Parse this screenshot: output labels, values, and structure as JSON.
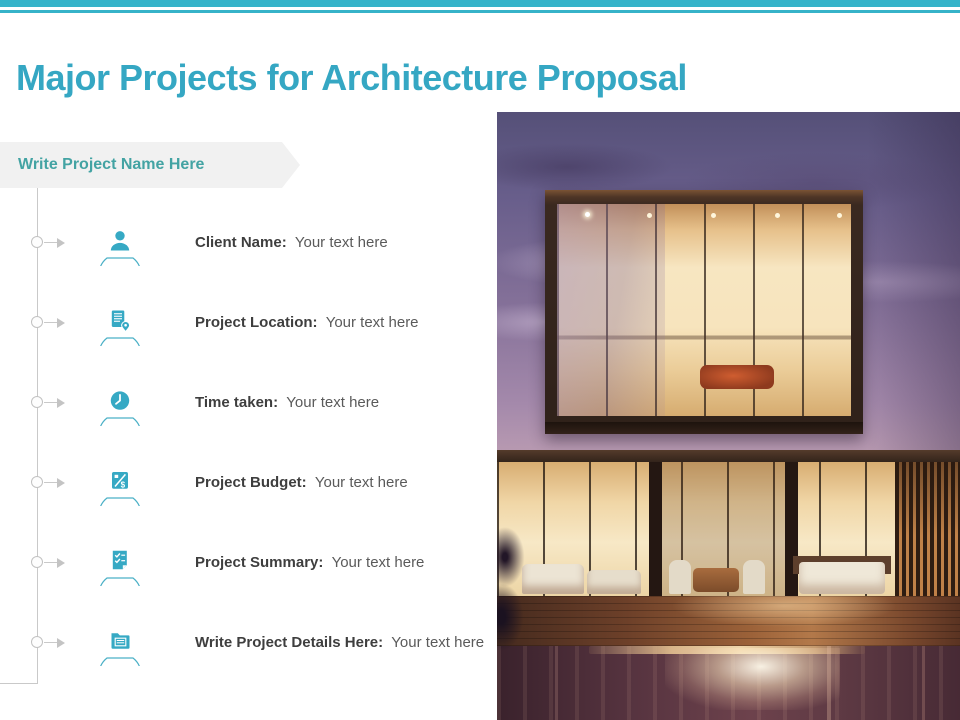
{
  "slide": {
    "title": "Major Projects for Architecture Proposal",
    "banner_label": "Write Project Name Here"
  },
  "rows": [
    {
      "icon": "client-person-icon",
      "label": "Client Name:",
      "value": "Your text here"
    },
    {
      "icon": "location-document-icon",
      "label": "Project Location:",
      "value": "Your text here"
    },
    {
      "icon": "clock-icon",
      "label": "Time taken:",
      "value": "Your text here"
    },
    {
      "icon": "budget-calculator-icon",
      "label": "Project Budget:",
      "value": "Your text here"
    },
    {
      "icon": "summary-checklist-icon",
      "label": "Project Summary:",
      "value": "Your text here"
    },
    {
      "icon": "details-folder-icon",
      "label": "Write Project Details Here:",
      "value": "Your text here"
    }
  ],
  "photo": {
    "description": "Modern two-storey house at dusk with glowing interiors, wooden deck and pool"
  },
  "colors": {
    "accent_bar": "#36b3c9",
    "title_text": "#35a7c3",
    "banner_text": "#43a3a3",
    "banner_bg": "#f1f1f1",
    "icon_teal": "#36a9c4",
    "label_text": "#3e3e3e",
    "value_text": "#5a5a5a",
    "timeline_gray": "#c9c9c9"
  }
}
